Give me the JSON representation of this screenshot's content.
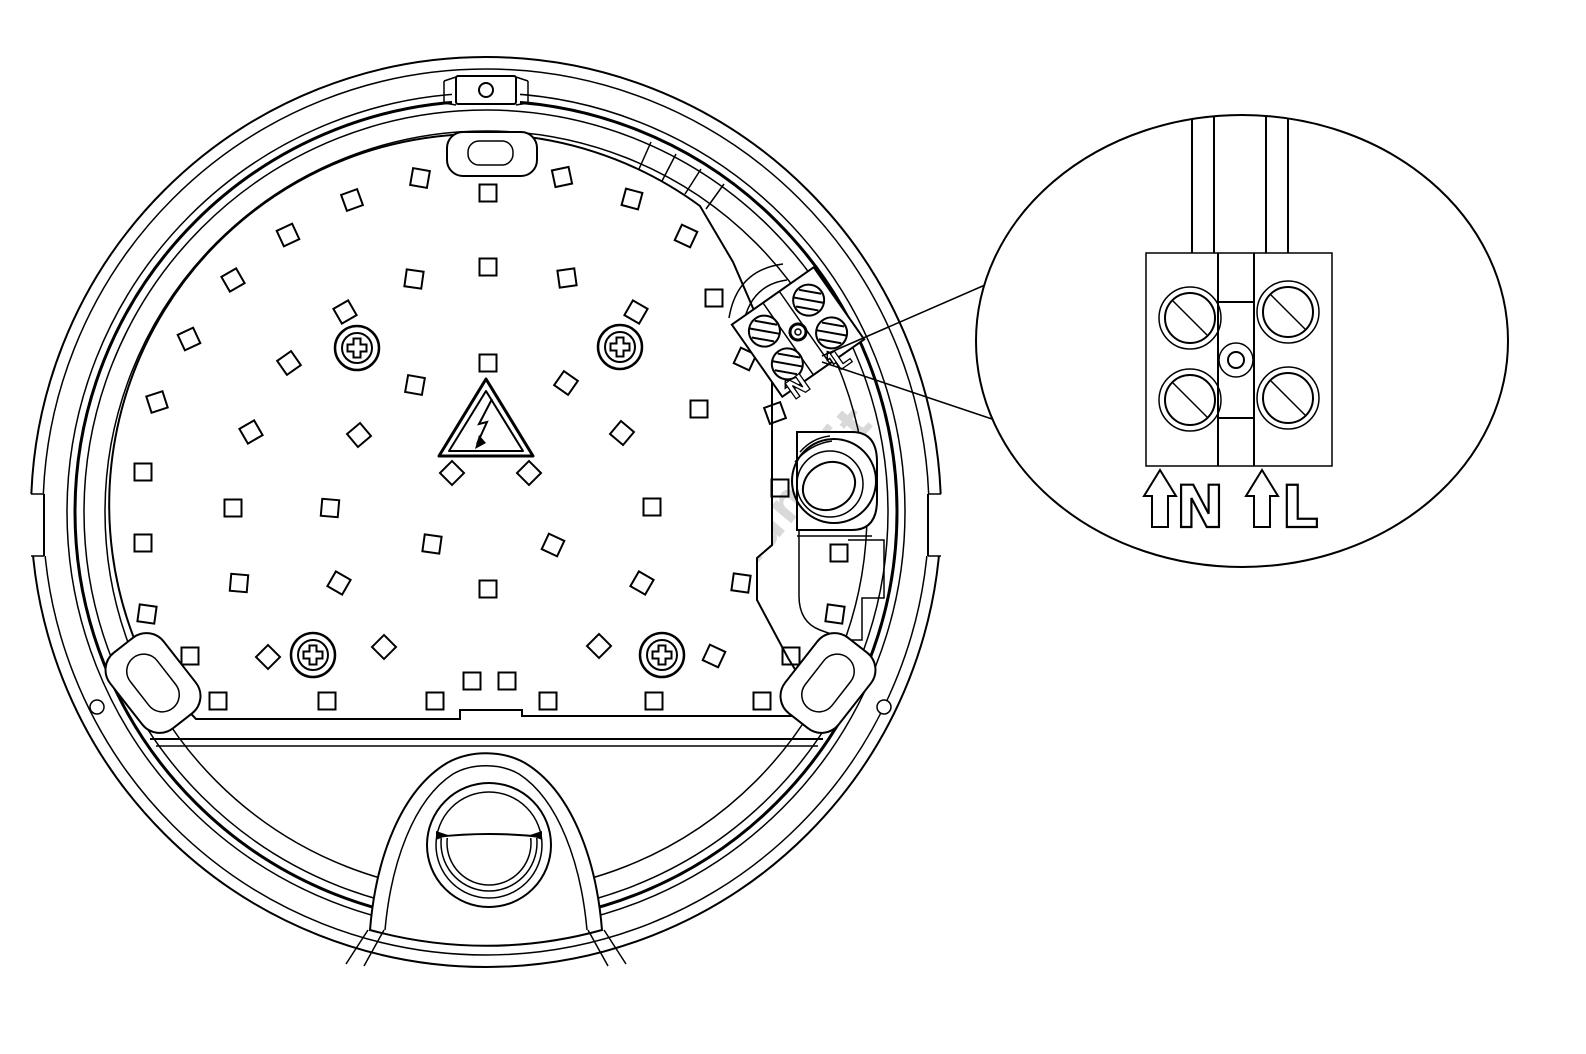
{
  "diagram": {
    "subject": "round-bulkhead-luminaire-internal-view",
    "watermark": "luciano.it",
    "colors": {
      "line": "#000000",
      "background": "#ffffff",
      "watermark": "#d9d9d9"
    },
    "main_view": {
      "terminal_labels": {
        "neutral": "N",
        "line": "L"
      }
    },
    "detail_view": {
      "labels": {
        "neutral": "N",
        "line": "L"
      }
    },
    "led_squares": [
      [
        420,
        178,
        10
      ],
      [
        352,
        200,
        -20
      ],
      [
        288,
        235,
        -25
      ],
      [
        488,
        193,
        0
      ],
      [
        562,
        177,
        -12
      ],
      [
        632,
        199,
        15
      ],
      [
        686,
        236,
        25
      ],
      [
        233,
        280,
        -30
      ],
      [
        414,
        279,
        8
      ],
      [
        488,
        267,
        0
      ],
      [
        567,
        278,
        -8
      ],
      [
        714,
        298,
        0
      ],
      [
        189,
        339,
        -25
      ],
      [
        345,
        312,
        -30
      ],
      [
        636,
        312,
        30
      ],
      [
        745,
        359,
        25
      ],
      [
        157,
        402,
        -18
      ],
      [
        289,
        363,
        -35
      ],
      [
        488,
        363,
        0
      ],
      [
        566,
        383,
        35
      ],
      [
        415,
        385,
        10
      ],
      [
        251,
        432,
        -30
      ],
      [
        359,
        435,
        -40
      ],
      [
        622,
        433,
        40
      ],
      [
        699,
        409,
        0
      ],
      [
        775,
        413,
        -20
      ],
      [
        452,
        473,
        45
      ],
      [
        529,
        473,
        45
      ],
      [
        143,
        472,
        0
      ],
      [
        780,
        488,
        0
      ],
      [
        233,
        508,
        0
      ],
      [
        330,
        508,
        5
      ],
      [
        652,
        507,
        0
      ],
      [
        143,
        543,
        0
      ],
      [
        432,
        544,
        8
      ],
      [
        553,
        545,
        25
      ],
      [
        839,
        553,
        0
      ],
      [
        239,
        583,
        5
      ],
      [
        339,
        583,
        30
      ],
      [
        488,
        589,
        0
      ],
      [
        642,
        583,
        30
      ],
      [
        741,
        583,
        8
      ],
      [
        147,
        614,
        8
      ],
      [
        835,
        614,
        8
      ],
      [
        190,
        656,
        0
      ],
      [
        268,
        657,
        45
      ],
      [
        384,
        647,
        45
      ],
      [
        599,
        646,
        45
      ],
      [
        714,
        656,
        25
      ],
      [
        791,
        656,
        0
      ],
      [
        218,
        701,
        0
      ],
      [
        327,
        701,
        0
      ],
      [
        435,
        701,
        0
      ],
      [
        548,
        701,
        0
      ],
      [
        654,
        701,
        0
      ],
      [
        762,
        701,
        0
      ],
      [
        472,
        681,
        0
      ],
      [
        507,
        681,
        0
      ]
    ],
    "screws": [
      [
        357,
        348
      ],
      [
        620,
        347
      ],
      [
        313,
        655
      ],
      [
        662,
        655
      ]
    ]
  }
}
